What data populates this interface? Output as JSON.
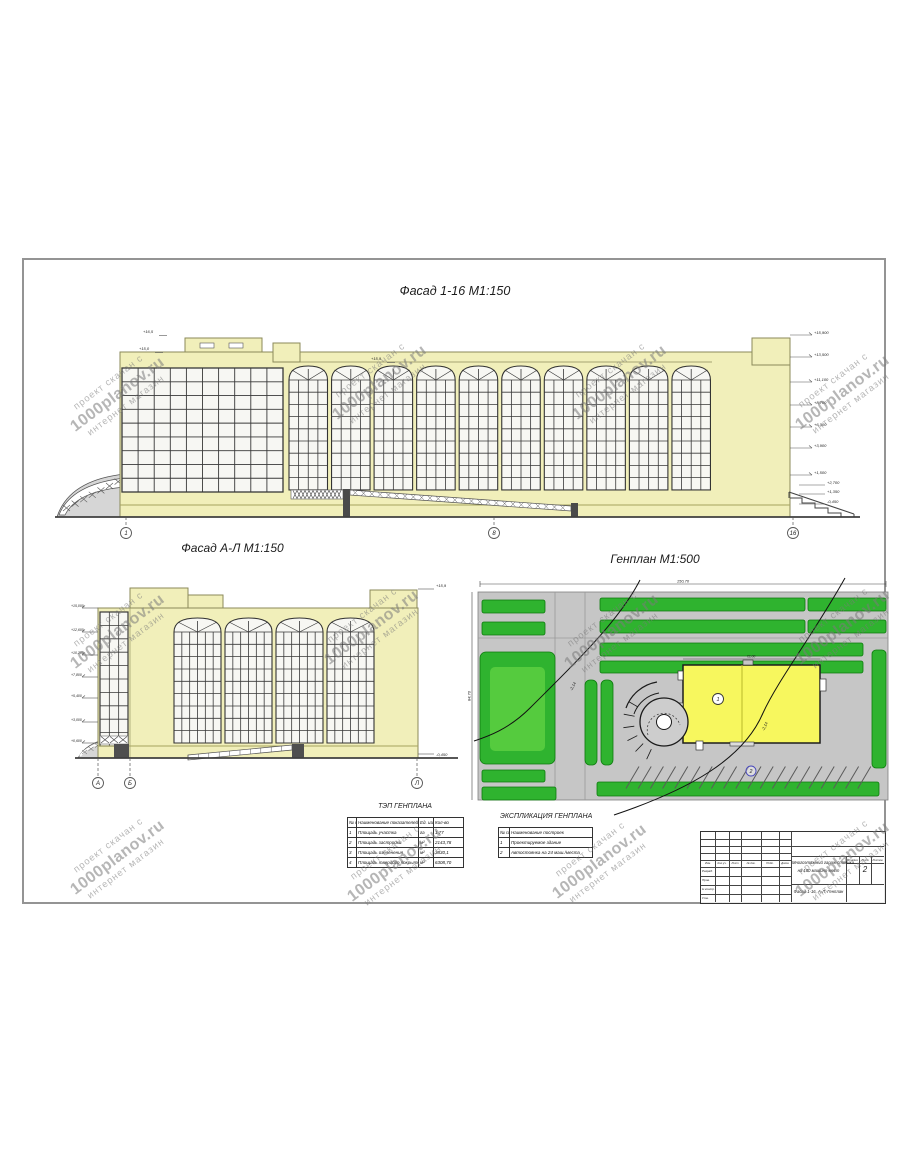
{
  "watermark": {
    "line1": "проект скачан с",
    "line2": "1000planov.ru",
    "line3": "интернет магазин"
  },
  "facade1": {
    "title": "Фасад 1-16 М1:150",
    "axis_labels": [
      "1",
      "8",
      "16"
    ],
    "elev_left": [
      "+15,0",
      "+16,5",
      "+15,9"
    ],
    "elev_right": [
      "+15,900",
      "+13,500",
      "+11,100",
      "+8,700",
      "+6,300",
      "+3,900",
      "+1,500"
    ],
    "elev_stair": [
      "+2,700",
      "+1,350",
      "-0,450"
    ]
  },
  "facadeAL": {
    "title": "Фасад А-Л М1:150",
    "axis_labels": [
      "А",
      "Б",
      "Л"
    ],
    "elev_left": [
      "+15,000",
      "+12,600",
      "+10,200",
      "+7,800",
      "+5,400",
      "+3,000",
      "+0,600"
    ],
    "elev_right_top": "+15,9",
    "elev_right_bottom": "-0,450"
  },
  "genplan": {
    "title": "Генплан М1:500",
    "dim_top": "150,70",
    "dim_left": "84,70",
    "dim_building": "72,00",
    "slope_label": "-2,14",
    "building_label": "1",
    "parking_label": "2"
  },
  "tep_table": {
    "title": "ТЭП ГЕНПЛАНА",
    "headers": [
      "№ п/п",
      "Наименование показателей",
      "Ед. изм.",
      "Кол-во"
    ],
    "rows": [
      [
        "1",
        "Площадь участка",
        "га",
        "1,77"
      ],
      [
        "2",
        "Площадь застройки",
        "м²",
        "2143,78"
      ],
      [
        "3",
        "Площадь озеленения",
        "м²",
        "3830,1"
      ],
      [
        "4",
        "Площадь твердого покрытия",
        "м²",
        "6308,70"
      ]
    ]
  },
  "explication_table": {
    "title": "ЭКСПЛИКАЦИЯ ГЕНПЛАНА",
    "headers": [
      "№ п/п",
      "Наименование построек"
    ],
    "rows": [
      [
        "1",
        "Проектируемое здание"
      ],
      [
        "2",
        "Автостоянка на 24 маш./места"
      ]
    ]
  },
  "titleblock": {
    "project_line1": "Многоэтажный гараж-стоянка",
    "project_line2": "на 180 машино-мест",
    "sheet_title": "Фасад 1-16, А-Л, Генплан",
    "stage_label": "Стадия",
    "list_label": "Лист",
    "listov_label": "Листов",
    "sheet_number": "2",
    "bottom_labels": [
      "Изм.",
      "Кол.уч.",
      "Лист",
      "№ док.",
      "Подп.",
      "Дата"
    ],
    "left_labels": [
      "Разраб.",
      "Пров.",
      "Н.контр.",
      "Утв."
    ]
  },
  "colors": {
    "wall": "#f1efba",
    "wall_stroke": "#8b8a5a",
    "window": "#f7f7f3",
    "frame": "#383838",
    "green": "#2fb32f",
    "green_dark": "#0d7a0d",
    "green_light": "#55cb3e",
    "pavement": "#c6c6c6",
    "gp_building": "#f7f75e",
    "parking_blue": "#4646bb"
  }
}
